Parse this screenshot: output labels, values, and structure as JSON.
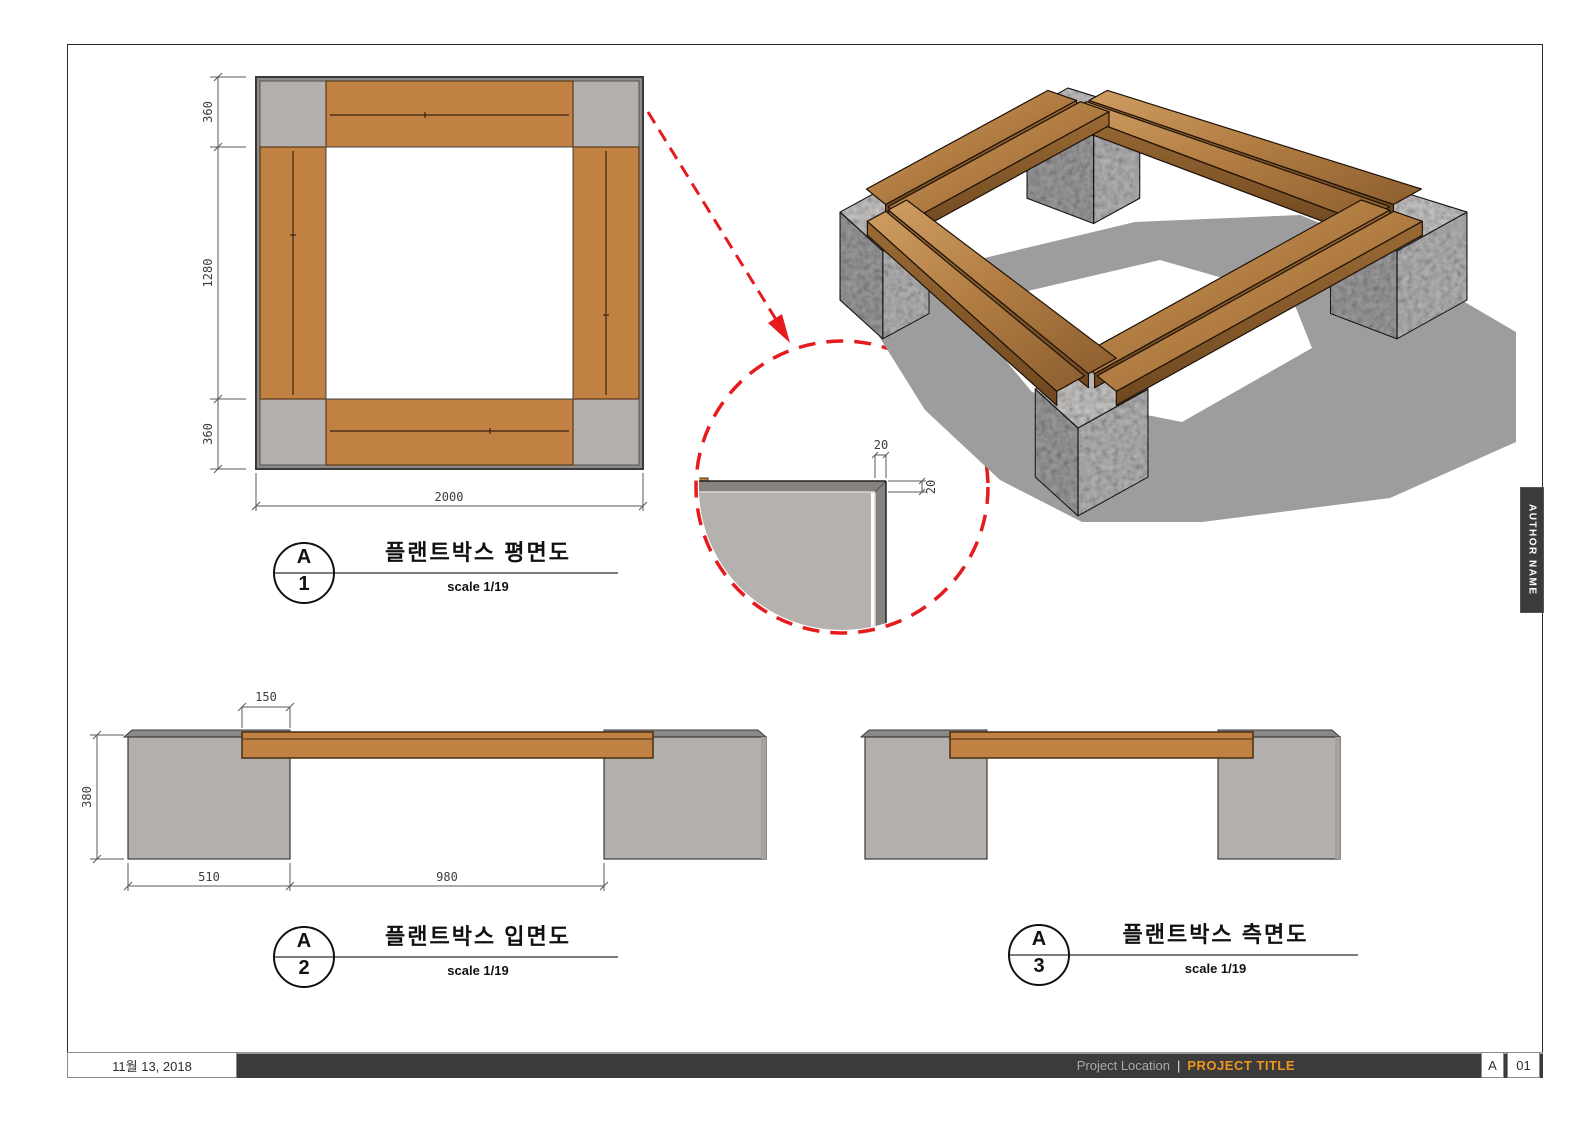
{
  "sheet": {
    "date": "11월 13, 2018",
    "project_location": "Project Location",
    "separator": "|",
    "project_title": "PROJECT TITLE",
    "revision": "A",
    "sheet_number": "01",
    "author": "AUTHOR NAME"
  },
  "views": {
    "plan": {
      "ref_letter": "A",
      "ref_number": "1",
      "title": "플랜트박스 평면도",
      "scale": "scale 1/19",
      "dims": {
        "side_top": "360",
        "side_middle": "1280",
        "side_bottom": "360",
        "width": "2000"
      }
    },
    "elevation": {
      "ref_letter": "A",
      "ref_number": "2",
      "title": "플랜트박스 입면도",
      "scale": "scale 1/19",
      "dims": {
        "overlap": "150",
        "height": "380",
        "block": "510",
        "span": "980"
      }
    },
    "side": {
      "ref_letter": "A",
      "ref_number": "3",
      "title": "플랜트박스 측면도",
      "scale": "scale 1/19"
    }
  },
  "detail": {
    "dim_top": "20",
    "dim_right": "20"
  },
  "colors": {
    "wood": "#c08142",
    "wood_outline": "#4a2e12",
    "block_gray": "#b3b0ad",
    "edge_gray": "#8d8a87",
    "strip_gray": "#8a8886",
    "stone_light": "#cbc9c7",
    "stone_mid": "#b7b6b8",
    "stone_dark": "#9e9da0",
    "shadow": "#9d9d9d",
    "accent_red": "#e51b1e",
    "footer_bar": "#3b3b3b",
    "title_orange": "#f0951d"
  }
}
